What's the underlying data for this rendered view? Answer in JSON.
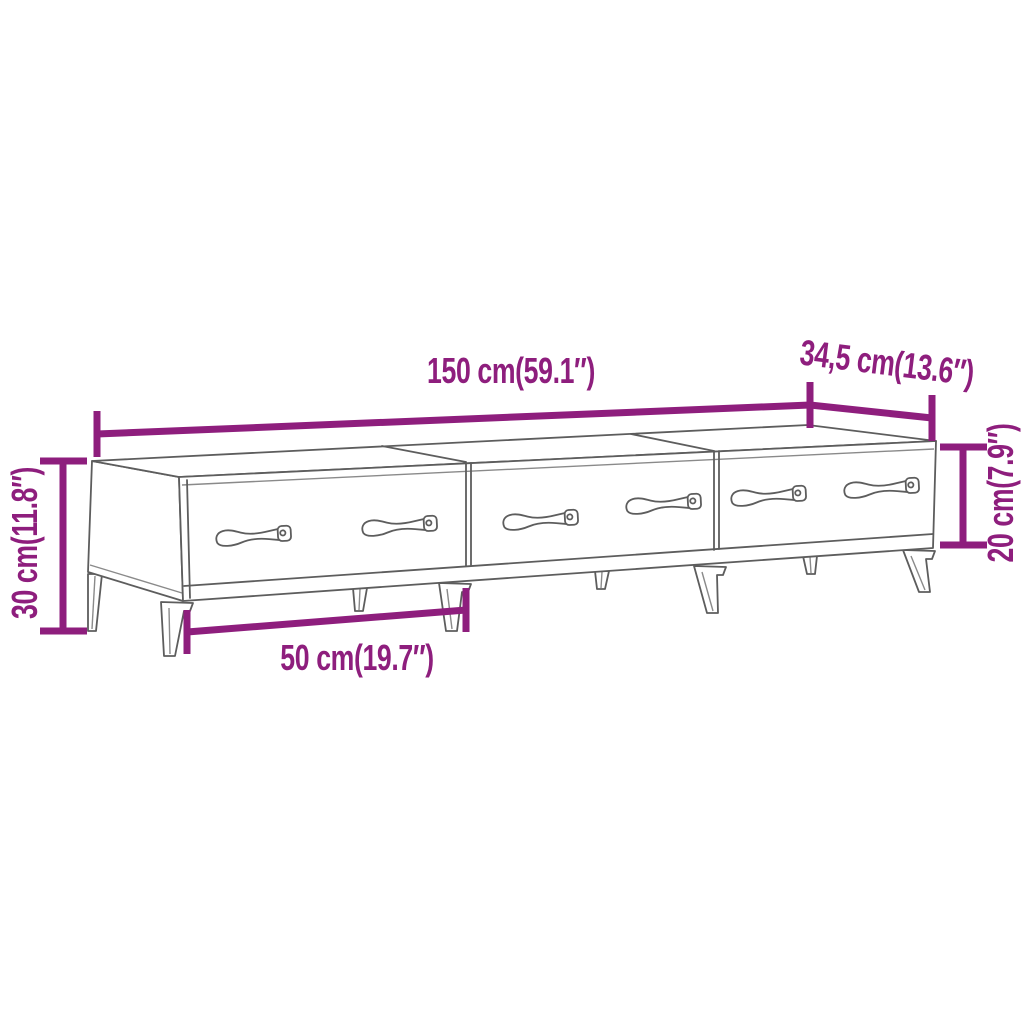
{
  "diagram": {
    "type": "furniture-dimension-diagram",
    "subject": "tv-cabinet-with-3-drawers",
    "colors": {
      "background": "#FFFFFF",
      "dimension_accent": "#8E1E7D",
      "drawing_outline": "#5D5D5D"
    },
    "dimensions": {
      "width": {
        "label": "150 cm(59.1″)"
      },
      "depth": {
        "label": "34,5 cm(13.6″)"
      },
      "body_height": {
        "label": "20 cm(7.9″)"
      },
      "total_height": {
        "label": "30 cm(11.8″)"
      },
      "drawer_width": {
        "label": "50 cm(19.7″)"
      }
    }
  }
}
